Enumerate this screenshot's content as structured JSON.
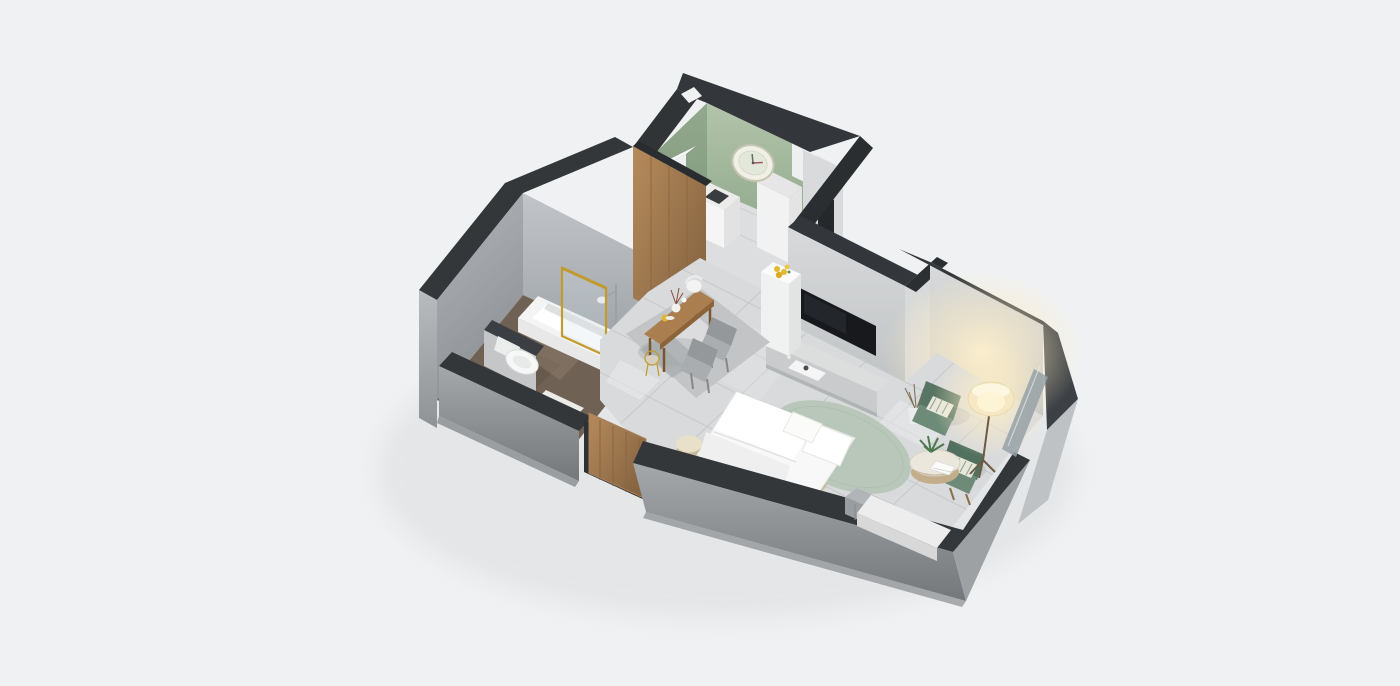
{
  "scene": {
    "kind": "3d-isometric-floorplan-render",
    "subject": "Studio apartment cutaway floor plan rendered in top-down isometric 3D on a plain light gray background",
    "view": "isometric cutaway from above"
  },
  "palette": {
    "background": "#f0f1f2",
    "wall_top": "#34373a",
    "wall_face": "#cdd0d1",
    "wall_outer": "#9a9ea1",
    "kitchen_green": "#9fb69a",
    "wood": "#a8815a",
    "floor_marble": "#d8dadb",
    "floor_bath": "#6f6154",
    "rug_gray": "#c2c4c5",
    "rug_sage": "#b6c6b8",
    "armchair_green": "#587463",
    "lamp_glow": "#f6e8c4",
    "gold": "#c19b2e",
    "tv_screen": "#17191c",
    "accent_yellow": "#e3b92e",
    "linen_white": "#f7f8f7"
  },
  "rooms": {
    "kitchen": {
      "name": "kitchen",
      "features": [
        "sage-green-walls",
        "wall-clock",
        "white-cabinets",
        "kitchen-counter",
        "tall-cabinet",
        "cooktop"
      ]
    },
    "bathroom": {
      "name": "bathroom",
      "features": [
        "gray-tile-walls",
        "bathtub",
        "gold-framed-shower-screen",
        "rain-shower",
        "toilet",
        "half-wall-partition",
        "bath-mat",
        "dark-wood-floor"
      ]
    },
    "dining": {
      "name": "dining-area",
      "features": [
        "wood-slat-panel-wall",
        "wooden-dining-table",
        "gray-upholstered-chairs",
        "white-chair",
        "gold-wire-chair",
        "gray-area-rug",
        "vase-with-branches",
        "yellow-carafe"
      ]
    },
    "living_bedroom": {
      "name": "living-bedroom",
      "features": [
        "wall-mounted-tv",
        "media-console",
        "decor-tray",
        "double-bed",
        "white-bedding",
        "pillows",
        "round-sage-rug",
        "rattan-poufs",
        "column-with-yellow-flowers"
      ]
    },
    "lounge_corner": {
      "name": "lounge-corner",
      "features": [
        "two-green-armchairs",
        "striped-cushions",
        "round-coffee-table",
        "potted-plant",
        "white-book",
        "lit-floor-lamp",
        "dried-branches-vase",
        "warm-wall-glow"
      ]
    },
    "entry": {
      "name": "entry",
      "features": [
        "wooden-slatted-door"
      ]
    },
    "window_seat": {
      "name": "window-seat",
      "features": [
        "white-bench",
        "slatted-cabinet",
        "glass-panel"
      ]
    }
  }
}
